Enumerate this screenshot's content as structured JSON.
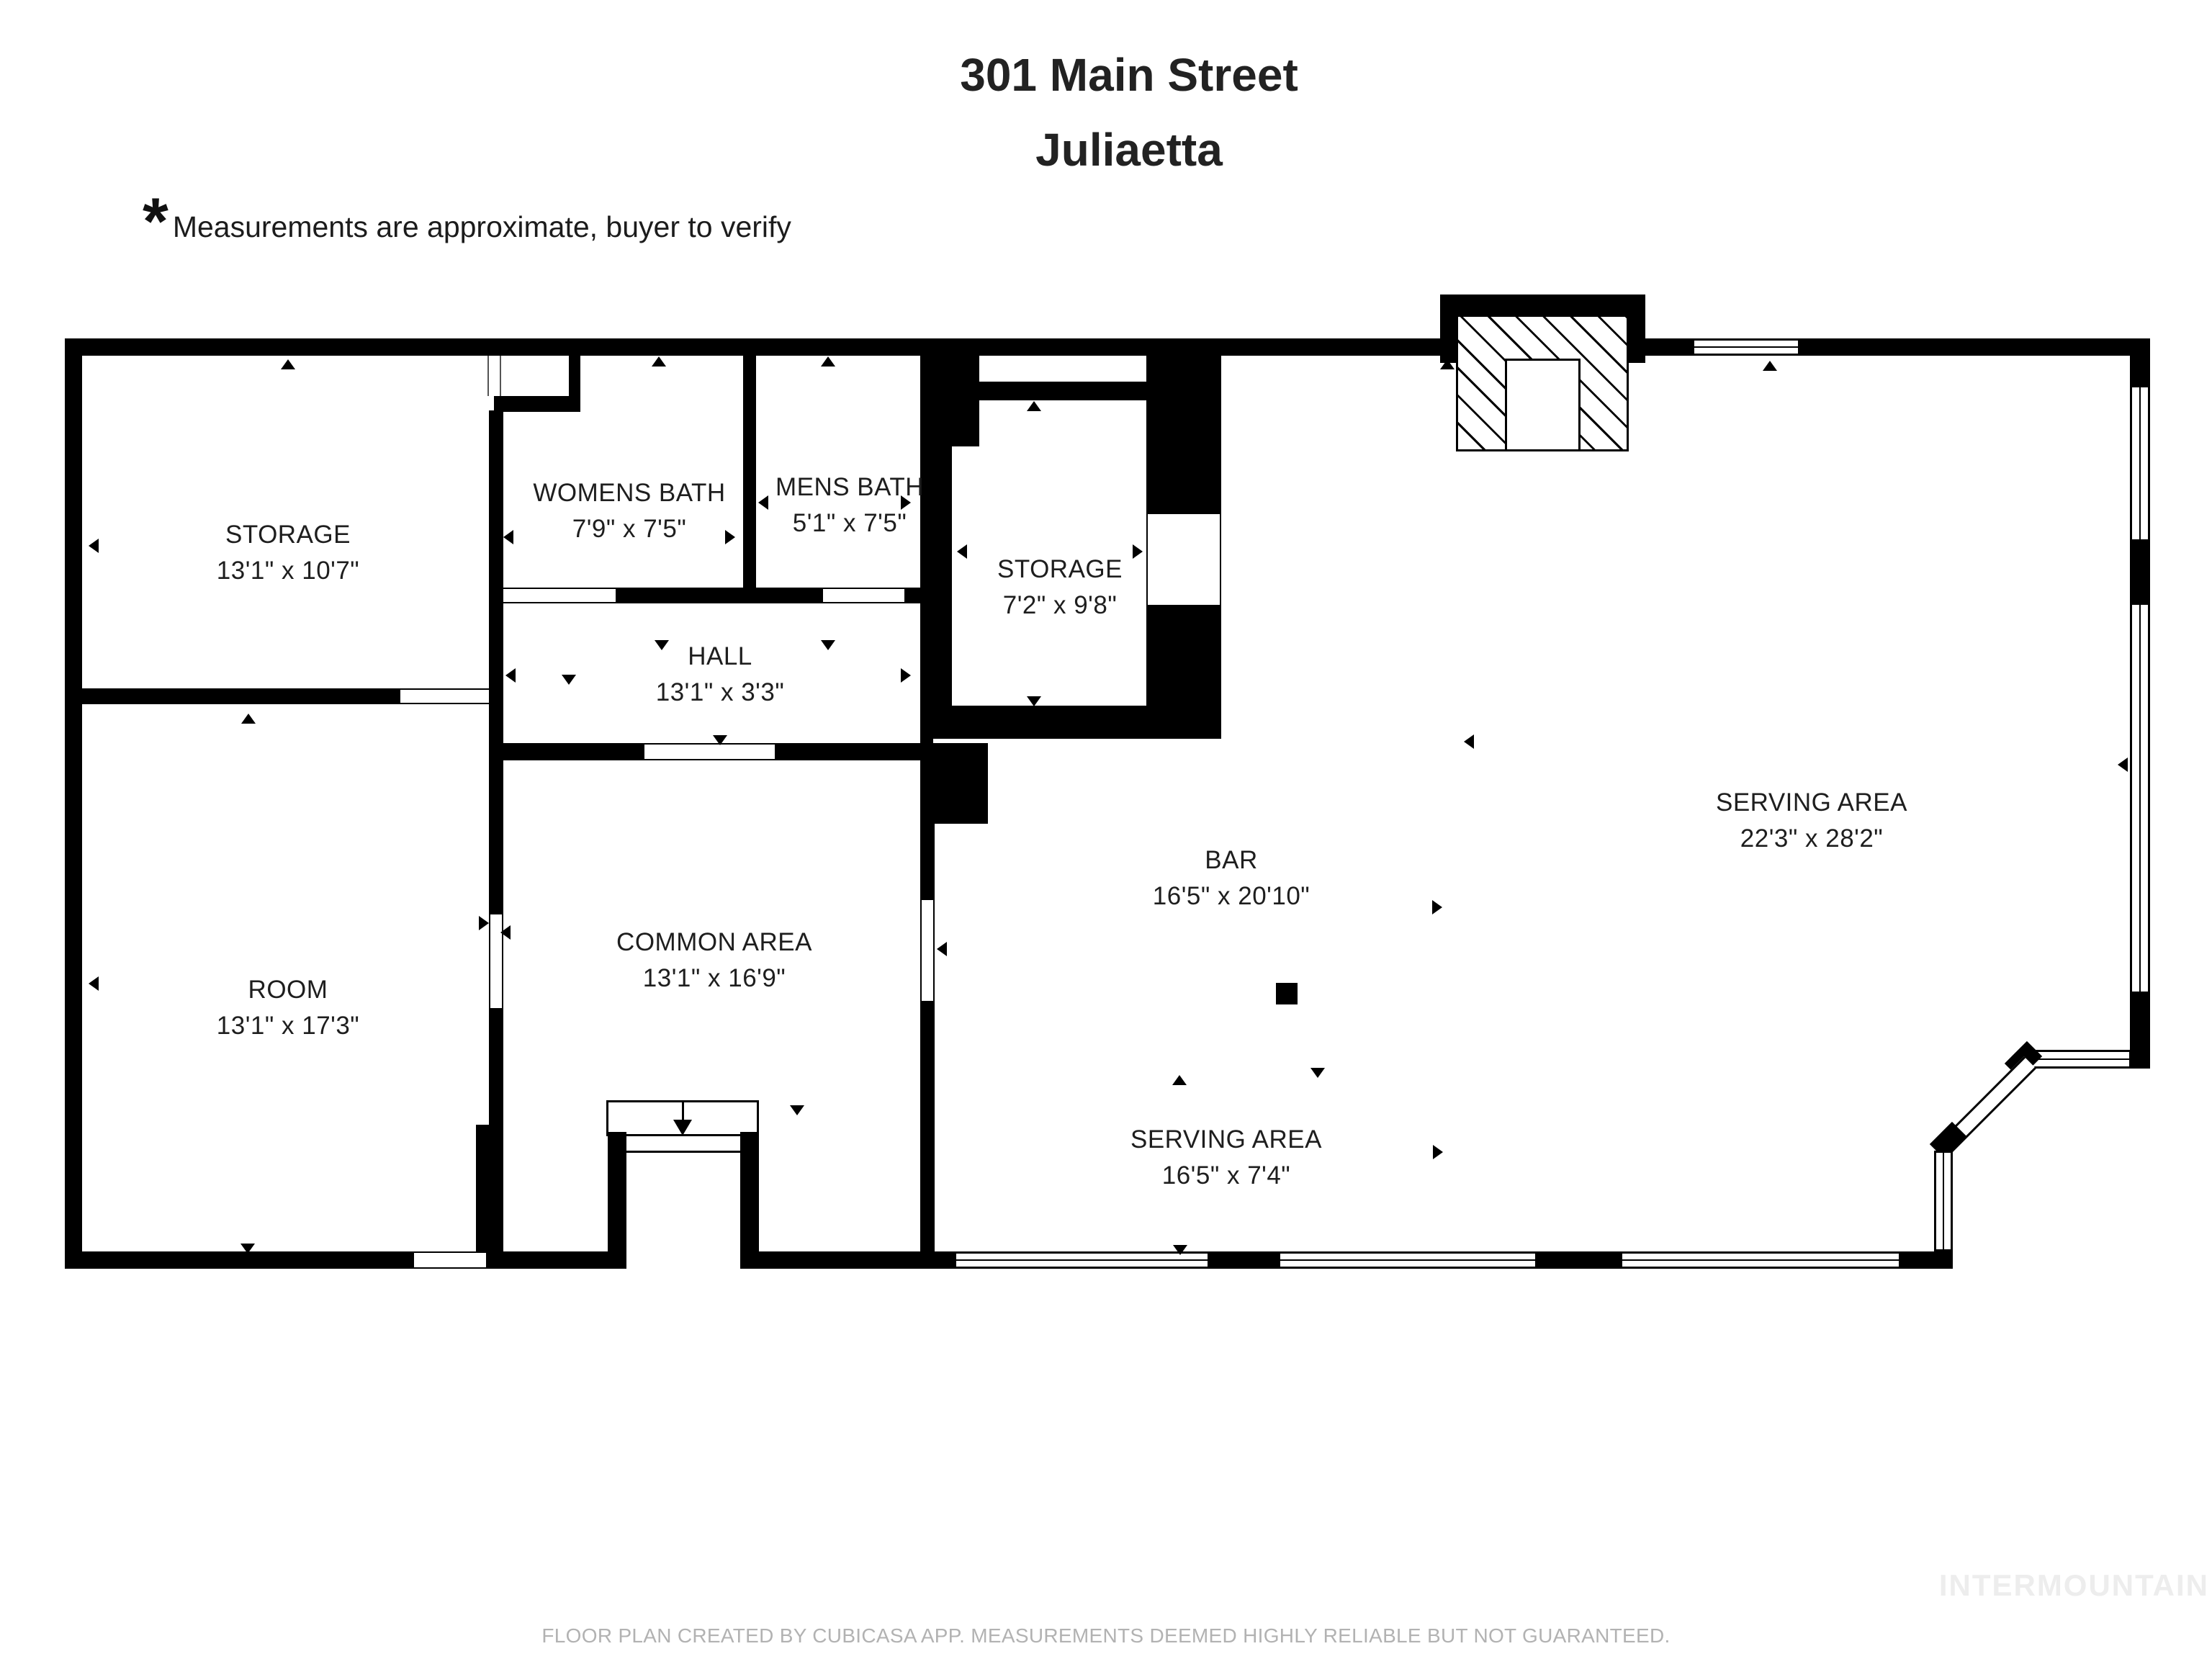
{
  "title": {
    "line1": "301 Main Street",
    "line2": "Juliaetta"
  },
  "note": {
    "asterisk": "*",
    "text": "Measurements are approximate, buyer to verify"
  },
  "rooms": [
    {
      "name": "STORAGE",
      "dims": "13'1\" x 10'7\""
    },
    {
      "name": "WOMENS BATH",
      "dims": "7'9\" x 7'5\""
    },
    {
      "name": "MENS BATH",
      "dims": "5'1\" x 7'5\""
    },
    {
      "name": "STORAGE",
      "dims": "7'2\" x 9'8\""
    },
    {
      "name": "HALL",
      "dims": "13'1\" x 3'3\""
    },
    {
      "name": "ROOM",
      "dims": "13'1\" x 17'3\""
    },
    {
      "name": "COMMON AREA",
      "dims": "13'1\" x 16'9\""
    },
    {
      "name": "BAR",
      "dims": "16'5\" x 20'10\""
    },
    {
      "name": "SERVING AREA",
      "dims": "22'3\" x 28'2\""
    },
    {
      "name": "SERVING AREA",
      "dims": "16'5\" x 7'4\""
    }
  ],
  "footer": {
    "disclaimer": "FLOOR PLAN CREATED BY CUBICASA APP. MEASUREMENTS DEEMED HIGHLY RELIABLE BUT NOT GUARANTEED.",
    "watermark": "INTERMOUNTAIN"
  },
  "colors": {
    "wall": "#000000",
    "label_text": "#1e1e1e",
    "footer_text": "#b2b2b2",
    "watermark_text": "#ededed",
    "background": "#ffffff"
  }
}
